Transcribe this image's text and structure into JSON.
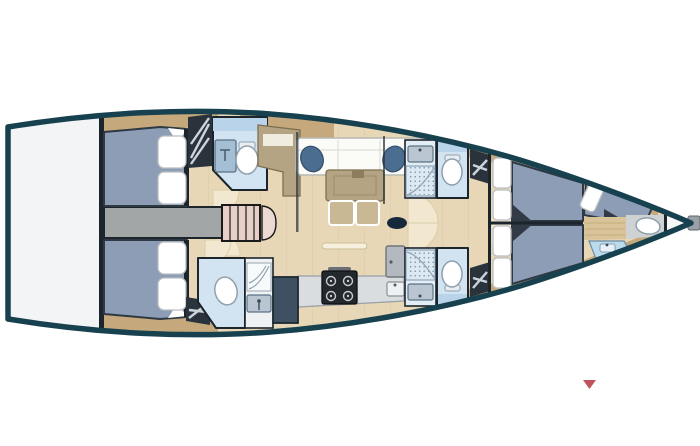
{
  "figure": {
    "type": "sailboat-interior-deck-plan",
    "orientation": "bow-right"
  },
  "palette": {
    "hull_outline": "#17414f",
    "deck_white": "#f3f4f6",
    "floor_tan": "#e8d7b6",
    "floor_light": "#f3e9d2",
    "wood_trim": "#c5a97c",
    "bed_blue": "#8c9db5",
    "bed_border": "#2e3944",
    "pillow_white": "#ffffff",
    "dark_locker": "#2a323c",
    "locker_stripe": "#cdd5dc",
    "corridor_gray": "#a3a6a6",
    "stairs_pink": "#e6cfc7",
    "head_blue": "#d2e3f2",
    "head_cabinet_blue": "#b9d3ea",
    "shower_glass": "#a4bed3",
    "fixture_outline": "#8fa0ad",
    "navy_cushion": "#4b6d90",
    "navy_cabinet": "#3e5062",
    "table_khaki": "#b4a483",
    "sofa_white": "#fbfbf8",
    "counter_gray": "#d9dde0",
    "stove_dark": "#23282e",
    "mast_dark": "#16293a",
    "bulkhead_dark": "#1c242c",
    "marker_red": "#c0545c"
  },
  "marker": {
    "shape": "triangle-down"
  }
}
